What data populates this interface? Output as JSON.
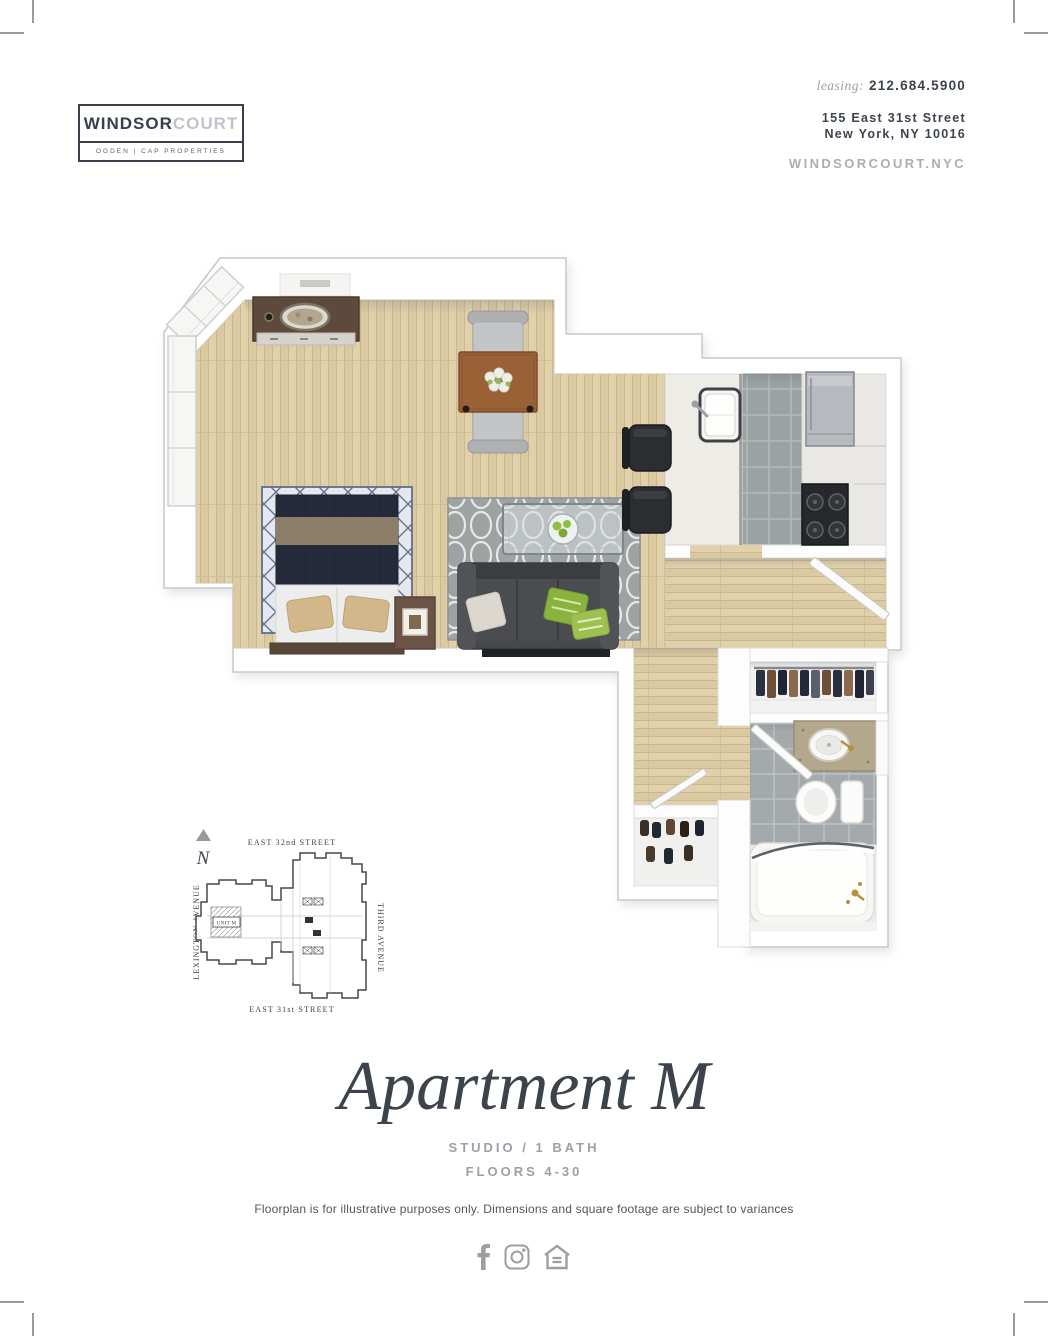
{
  "header": {
    "logo": {
      "brand_primary": "WINDSOR",
      "brand_secondary": "COURT",
      "tagline": "OGDEN | CAP PROPERTIES"
    },
    "contact": {
      "leasing_label": "leasing:",
      "phone": "212.684.5900",
      "address_line1": "155 East 31st Street",
      "address_line2": "New York, NY 10016",
      "website": "WINDSORCOURT.NYC"
    }
  },
  "site_map": {
    "north_label": "N",
    "street_top": "EAST 32nd STREET",
    "street_bottom": "EAST 31st STREET",
    "avenue_left": "LEXINGTON AVENUE",
    "avenue_right": "THIRD AVENUE",
    "unit_label": "UNIT M"
  },
  "details": {
    "title": "Apartment M",
    "spec_line1": "STUDIO / 1 BATH",
    "spec_line2": "FLOORS 4-30",
    "disclaimer": "Floorplan is for illustrative purposes only. Dimensions and square footage are subject to variances"
  },
  "footer": {
    "icons": [
      "facebook-icon",
      "instagram-icon",
      "equal-housing-icon"
    ]
  },
  "colors": {
    "brand_dark": "#39404c",
    "muted_gray": "#9aa0a7",
    "wood_floor": "#e1d1ab",
    "tile_gray": "#9ca1a3",
    "navy_bedding": "#262b3b",
    "accent_green": "#8fbf3e",
    "icon_gray": "#9e9e9e"
  }
}
